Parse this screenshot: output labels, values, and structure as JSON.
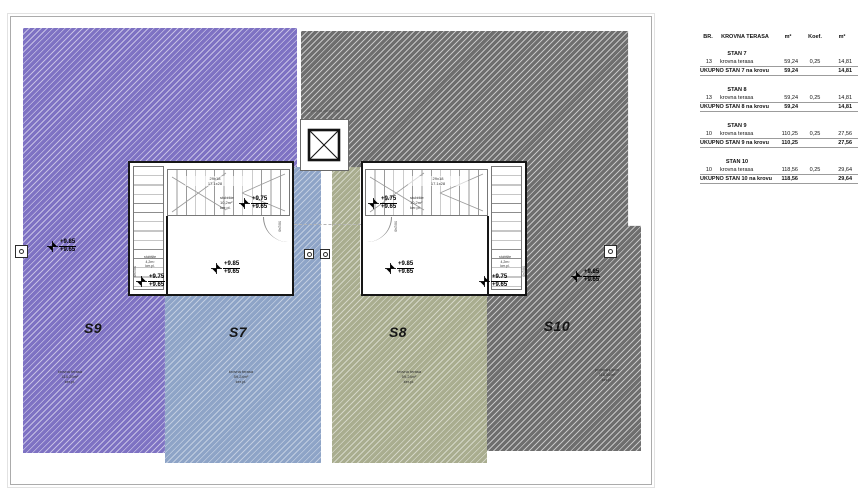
{
  "colors": {
    "s7": "#8ea4c7",
    "s8": "#a9ad8f",
    "s9": "#7e72c3",
    "s10": "#6e6e6e"
  },
  "plan": {
    "units": {
      "s9": {
        "label": "S9",
        "area_note": [
          "krovna terasa",
          "110,25m²",
          "ker.pl."
        ]
      },
      "s7": {
        "label": "S7",
        "area_note": [
          "krovna terasa",
          "59,24m²",
          "ker.pl."
        ]
      },
      "s8": {
        "label": "S8",
        "area_note": [
          "krovna terasa",
          "59,24m²",
          "ker.pl."
        ]
      },
      "s10": {
        "label": "S10",
        "area_note": [
          "prohodni krov",
          "118,56m²",
          "ker.pl."
        ]
      }
    },
    "levels": {
      "terrace_top": "+9.85",
      "terrace_bottom": "+9.65",
      "landing_top": "+9.75",
      "landing_bottom": "+9.65"
    },
    "stairs": {
      "run_label_1": "29x18",
      "run_label_2": "17.1x28",
      "stair_room": [
        "stubište",
        "10,2m²",
        "ker.pl."
      ],
      "small_stair_room": [
        "stubište",
        "4,2m²",
        "ker.pl."
      ],
      "door_label": "90/240"
    },
    "skylight_label": "kupola za osvjetljenje"
  },
  "table": {
    "headers": [
      "BR.",
      "KROVNA TERASA",
      "m²",
      "Koef.",
      "m²"
    ],
    "groups": [
      {
        "title": "STAN 7",
        "row": {
          "br": "13",
          "name": "krovna terasa",
          "area": "59,24",
          "koef": "0,25",
          "result": "14,81"
        },
        "total": {
          "label": "UKUPNO STAN 7 na krovu",
          "area": "59,24",
          "result": "14,81"
        }
      },
      {
        "title": "STAN 8",
        "row": {
          "br": "13",
          "name": "krovna terasa",
          "area": "59,24",
          "koef": "0,25",
          "result": "14,81"
        },
        "total": {
          "label": "UKUPNO STAN 8 na krovu",
          "area": "59,24",
          "result": "14,81"
        }
      },
      {
        "title": "STAN 9",
        "row": {
          "br": "10",
          "name": "krovna terasa",
          "area": "110,25",
          "koef": "0,25",
          "result": "27,56"
        },
        "total": {
          "label": "UKUPNO STAN 9 na krovu",
          "area": "110,25",
          "result": "27,56"
        }
      },
      {
        "title": "STAN 10",
        "row": {
          "br": "10",
          "name": "krovna terasa",
          "area": "118,56",
          "koef": "0,25",
          "result": "29,64"
        },
        "total": {
          "label": "UKUPNO STAN 10 na krovu",
          "area": "118,56",
          "result": "29,64"
        }
      }
    ]
  }
}
